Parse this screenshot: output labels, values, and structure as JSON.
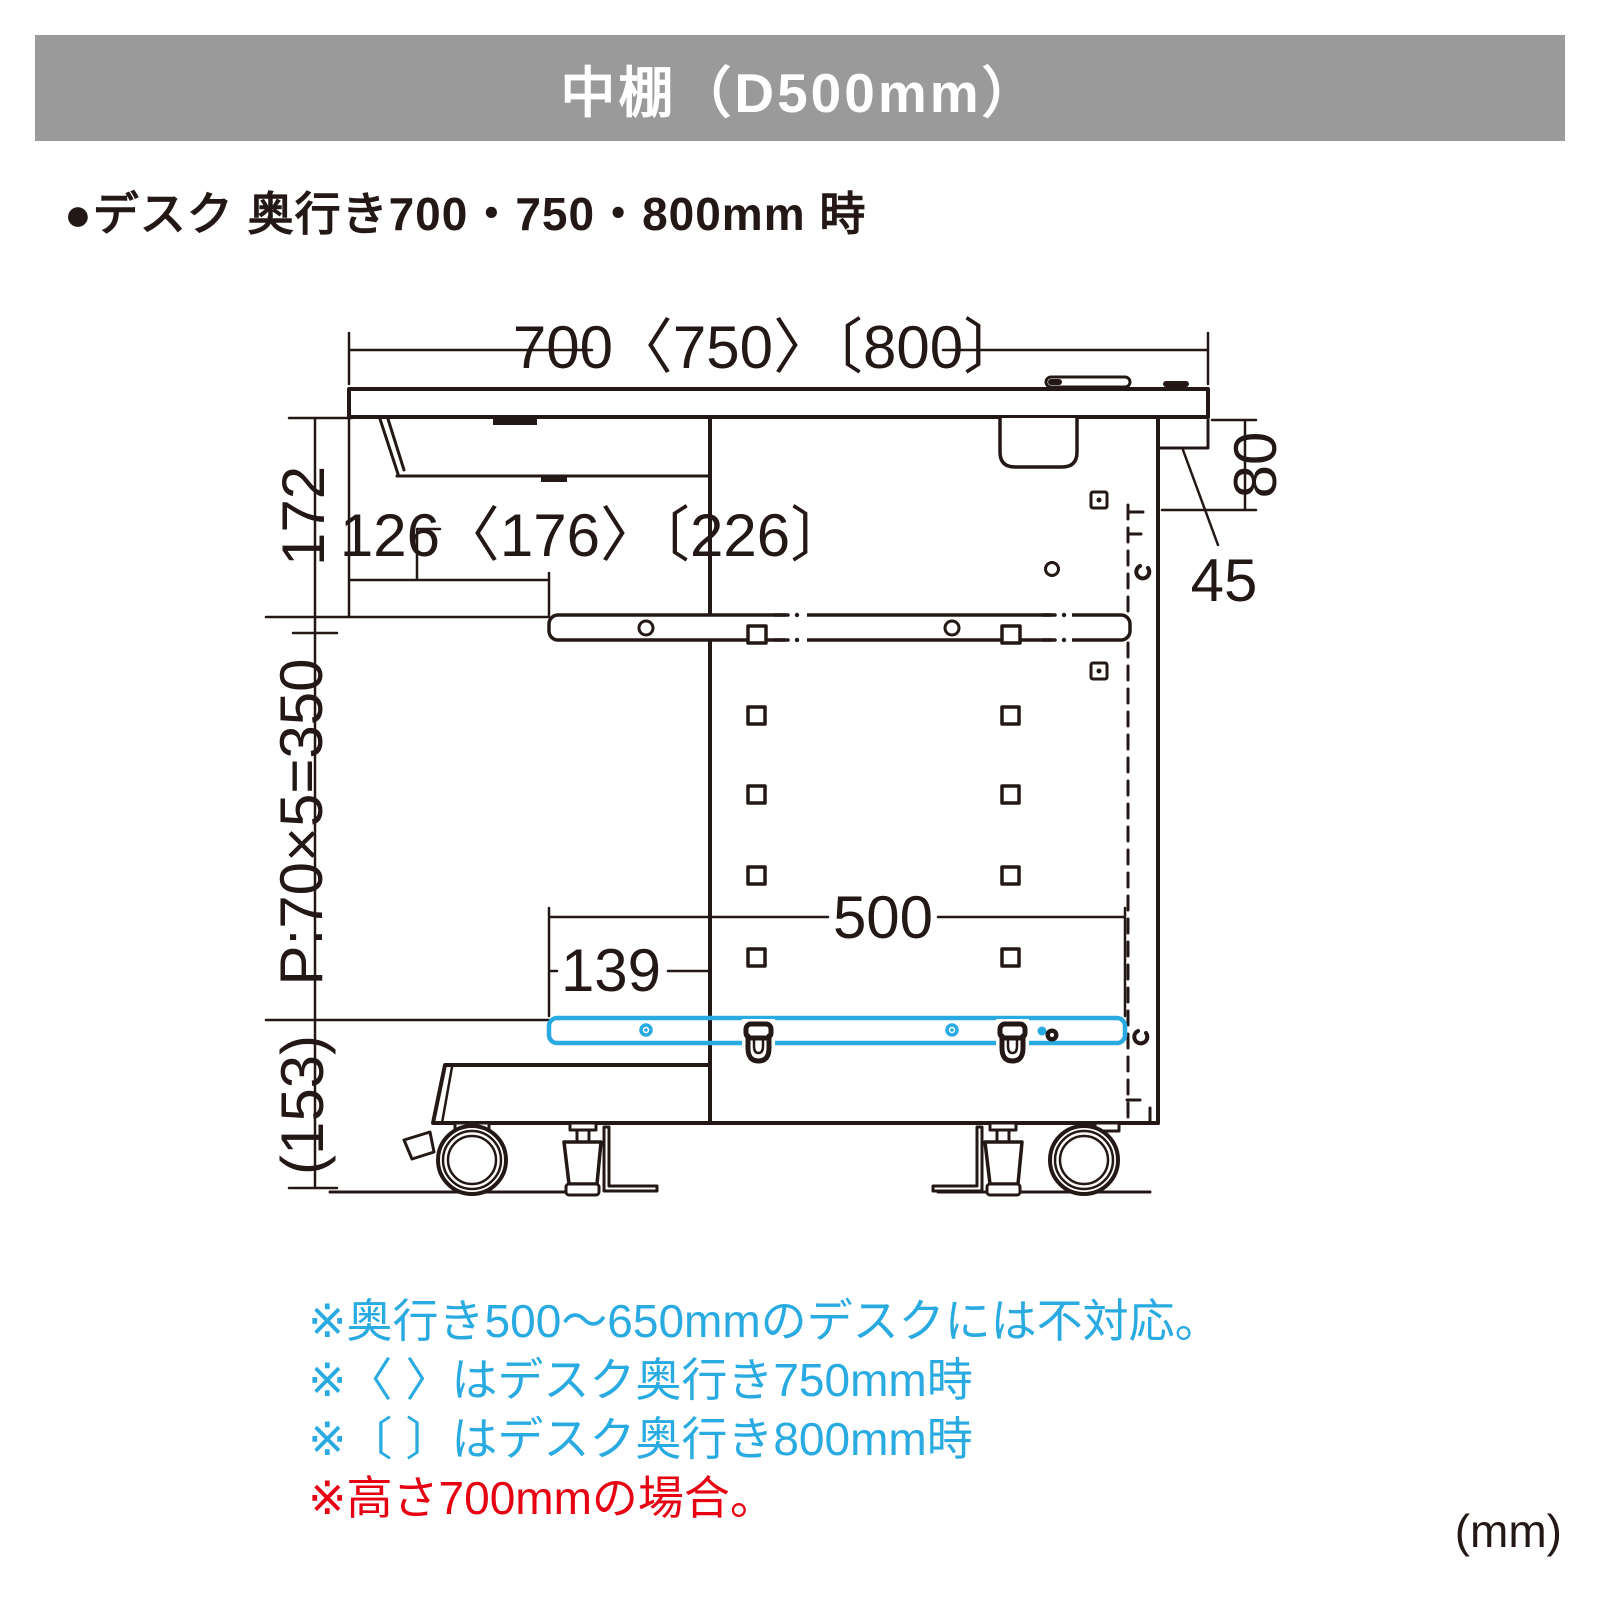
{
  "header": {
    "title": "中棚（D500mm）",
    "bg_color": "#9a9a9a"
  },
  "subheading": {
    "bullet_label": "●デスク 奥行き700・750・800mm 時"
  },
  "diagram": {
    "type": "dimension-drawing-side-view",
    "labels": {
      "desk_depth": "700〈750〉〔800〕",
      "top_to_shelf_bar": "172",
      "tray_inset": "126〈176〉〔226〕",
      "rear_clearance": "80",
      "rear_bracket": "45",
      "hole_pitch": "P:70×5=350",
      "shelf_depth": "500",
      "shelf_front_offset": "139",
      "floor_clearance": "(153)"
    },
    "colors": {
      "line": "#231815",
      "highlight_blue": "#29abe2"
    }
  },
  "notes": {
    "lines": [
      {
        "text": "※奥行き500〜650mmのデスクには不対応。",
        "color": "#29abe2"
      },
      {
        "text": "※〈 〉はデスク奥行き750mm時",
        "color": "#29abe2"
      },
      {
        "text": "※〔 〕はデスク奥行き800mm時",
        "color": "#29abe2"
      },
      {
        "text": "※高さ700mmの場合。",
        "color": "#e60012"
      }
    ]
  },
  "unit_label": "(mm)"
}
